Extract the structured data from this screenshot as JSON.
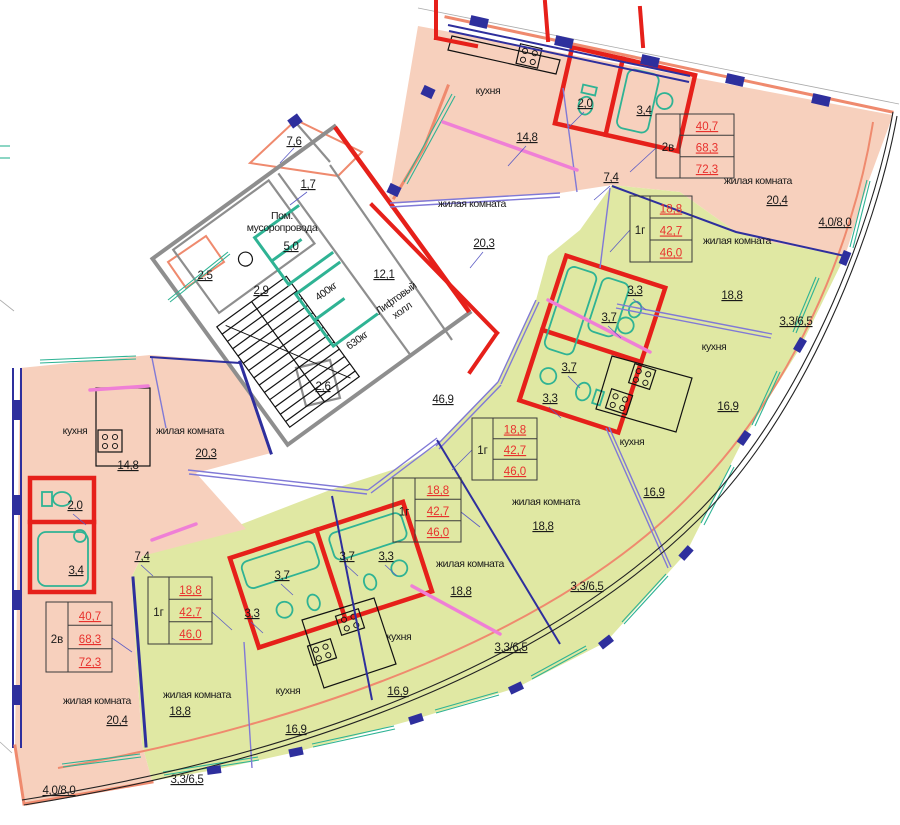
{
  "palette": {
    "apartment_2room_fill": "#f7d0bd",
    "apartment_1room_fill": "#e0e8a3",
    "wall_red": "#e6201a",
    "wall_blue": "#2e2f9d",
    "wall_purple": "#8079d6",
    "wall_pink": "#ef7fd6",
    "wall_salmon": "#ef8a6e",
    "fixture_teal": "#2fb394",
    "core_gray": "#8e8e8e",
    "value_red_text": "#e8312d"
  },
  "core": {
    "garbage_room": {
      "name_line1": "Пом.",
      "name_line2": "мусоропровода",
      "area": "5,0"
    },
    "lift_hall": {
      "name_line1": "Лифтовый",
      "name_line2": "холл",
      "area": "12,1"
    },
    "lift_small_capacity": "400кг",
    "lift_large_capacity": "630кг",
    "dims": {
      "balcony_top": "7,6",
      "niche": "1,7",
      "balcony_left": "2,5",
      "stair": "2,9",
      "bottom": "2,6"
    },
    "corridor_area": "46,9"
  },
  "apartments": [
    {
      "id": "top-right-2room",
      "type_label": "2в",
      "table": [
        "40,7",
        "68,3",
        "72,3"
      ],
      "kitchen": {
        "name": "кухня",
        "area": "14,8"
      },
      "living1": {
        "name": "жилая комната",
        "area": "20,3"
      },
      "living2": {
        "name": "жилая комната",
        "area": "20,4"
      },
      "wc_area": "2,0",
      "bath_area": "3,4",
      "hall_area": "7,4",
      "balcony": "4,0/8,0"
    },
    {
      "id": "green-1room-a",
      "type_label": "1г",
      "table": [
        "18,8",
        "42,7",
        "46,0"
      ],
      "living": {
        "name": "жилая комната",
        "area": "18,8"
      },
      "kitchen": {
        "name": "кухня",
        "area": "16,9"
      },
      "bath_area": "3,7",
      "hall_area": "3,3",
      "balcony": "3,3/6,5"
    },
    {
      "id": "green-1room-b",
      "type_label": "1г",
      "table": [
        "18,8",
        "42,7",
        "46,0"
      ],
      "living": {
        "name": "жилая комната",
        "area": "18,8"
      },
      "kitchen": {
        "name": "кухня",
        "area": "16,9"
      },
      "bath_area": "3,7",
      "hall_area": "3,3",
      "balcony": "3,3/6,5"
    },
    {
      "id": "green-1room-c",
      "type_label": "1г",
      "table": [
        "18,8",
        "42,7",
        "46,0"
      ],
      "living": {
        "name": "жилая комната",
        "area": "18,8"
      },
      "kitchen": {
        "name": "кухня",
        "area": "16,9"
      },
      "bath_area": "3,7",
      "hall_area": "3,3",
      "balcony": "3,3/6,5"
    },
    {
      "id": "green-1room-d",
      "type_label": "1г",
      "table": [
        "18,8",
        "42,7",
        "46,0"
      ],
      "living": {
        "name": "жилая комната",
        "area": "18,8"
      },
      "kitchen": {
        "name": "кухня",
        "area": "16,9"
      },
      "bath_area": "3,7",
      "hall_area": "3,3",
      "balcony": "3,3/6,5"
    },
    {
      "id": "bottom-left-2room",
      "type_label": "2в",
      "table": [
        "40,7",
        "68,3",
        "72,3"
      ],
      "kitchen": {
        "name": "кухня",
        "area": "14,8"
      },
      "living1": {
        "name": "жилая комната",
        "area": "20,3"
      },
      "living2": {
        "name": "жилая комната",
        "area": "20,4"
      },
      "wc_area": "2,0",
      "bath_area": "3,4",
      "hall_area": "7,4",
      "balcony": "4,0/8,0"
    }
  ]
}
